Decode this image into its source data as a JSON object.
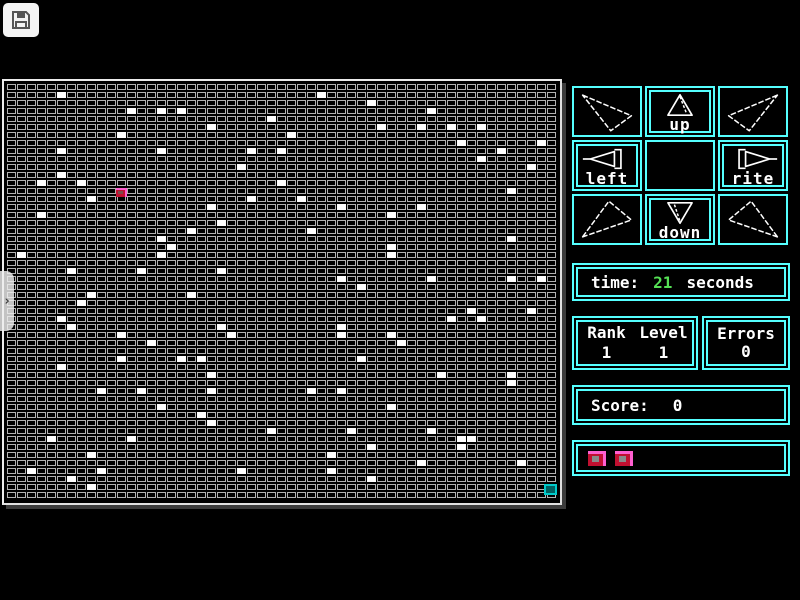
{
  "toolbar": {
    "save_icon": "floppy-disk"
  },
  "side_tab": {
    "chevron": "›"
  },
  "colors": {
    "panel_cyan": "#55ffff",
    "time_green": "#55e055",
    "text_white": "#ffffff",
    "player_red": "#c01030",
    "player_pink": "#ff5fd0",
    "goal_teal": "#00c9c9",
    "cell_gray": "#b2b2b2"
  },
  "dpad": {
    "up_label": "up",
    "left_label": "left",
    "rite_label": "rite",
    "down_label": "down"
  },
  "status": {
    "time_label": "time:",
    "time_value": "21",
    "time_unit": "seconds",
    "rank_label": "Rank",
    "level_label": "Level",
    "rank_value": "1",
    "level_value": "1",
    "errors_label": "Errors",
    "errors_value": "0",
    "score_label": "Score:",
    "score_value": "0",
    "lives_count": 2
  },
  "grid": {
    "cols": 55,
    "rows": 52,
    "player": {
      "col": 11,
      "row": 13
    },
    "goal": {
      "col": 54,
      "row": 50
    },
    "dots": [
      [
        5,
        1
      ],
      [
        31,
        1
      ],
      [
        36,
        2
      ],
      [
        12,
        3
      ],
      [
        15,
        3
      ],
      [
        17,
        3
      ],
      [
        42,
        3
      ],
      [
        26,
        4
      ],
      [
        20,
        5
      ],
      [
        37,
        5
      ],
      [
        41,
        5
      ],
      [
        44,
        5
      ],
      [
        47,
        5
      ],
      [
        11,
        6
      ],
      [
        28,
        6
      ],
      [
        45,
        7
      ],
      [
        53,
        7
      ],
      [
        5,
        8
      ],
      [
        15,
        8
      ],
      [
        24,
        8
      ],
      [
        27,
        8
      ],
      [
        49,
        8
      ],
      [
        47,
        9
      ],
      [
        23,
        10
      ],
      [
        52,
        10
      ],
      [
        5,
        11
      ],
      [
        3,
        12
      ],
      [
        7,
        12
      ],
      [
        27,
        12
      ],
      [
        50,
        13
      ],
      [
        8,
        14
      ],
      [
        24,
        14
      ],
      [
        29,
        14
      ],
      [
        20,
        15
      ],
      [
        33,
        15
      ],
      [
        41,
        15
      ],
      [
        3,
        16
      ],
      [
        38,
        16
      ],
      [
        21,
        17
      ],
      [
        18,
        18
      ],
      [
        30,
        18
      ],
      [
        15,
        19
      ],
      [
        50,
        19
      ],
      [
        16,
        20
      ],
      [
        38,
        20
      ],
      [
        1,
        21
      ],
      [
        15,
        21
      ],
      [
        38,
        21
      ],
      [
        6,
        23
      ],
      [
        13,
        23
      ],
      [
        21,
        23
      ],
      [
        33,
        24
      ],
      [
        42,
        24
      ],
      [
        50,
        24
      ],
      [
        53,
        24
      ],
      [
        35,
        25
      ],
      [
        8,
        26
      ],
      [
        18,
        26
      ],
      [
        7,
        27
      ],
      [
        46,
        28
      ],
      [
        52,
        28
      ],
      [
        5,
        29
      ],
      [
        44,
        29
      ],
      [
        47,
        29
      ],
      [
        6,
        30
      ],
      [
        21,
        30
      ],
      [
        33,
        30
      ],
      [
        11,
        31
      ],
      [
        22,
        31
      ],
      [
        33,
        31
      ],
      [
        38,
        31
      ],
      [
        14,
        32
      ],
      [
        39,
        32
      ],
      [
        11,
        34
      ],
      [
        17,
        34
      ],
      [
        19,
        34
      ],
      [
        35,
        34
      ],
      [
        5,
        35
      ],
      [
        20,
        36
      ],
      [
        43,
        36
      ],
      [
        50,
        36
      ],
      [
        50,
        37
      ],
      [
        9,
        38
      ],
      [
        13,
        38
      ],
      [
        20,
        38
      ],
      [
        30,
        38
      ],
      [
        33,
        38
      ],
      [
        15,
        40
      ],
      [
        38,
        40
      ],
      [
        19,
        41
      ],
      [
        20,
        42
      ],
      [
        26,
        43
      ],
      [
        34,
        43
      ],
      [
        42,
        43
      ],
      [
        4,
        44
      ],
      [
        12,
        44
      ],
      [
        45,
        44
      ],
      [
        46,
        44
      ],
      [
        36,
        45
      ],
      [
        45,
        45
      ],
      [
        8,
        46
      ],
      [
        32,
        46
      ],
      [
        41,
        47
      ],
      [
        51,
        47
      ],
      [
        2,
        48
      ],
      [
        9,
        48
      ],
      [
        23,
        48
      ],
      [
        32,
        48
      ],
      [
        6,
        49
      ],
      [
        36,
        49
      ],
      [
        8,
        50
      ]
    ]
  }
}
